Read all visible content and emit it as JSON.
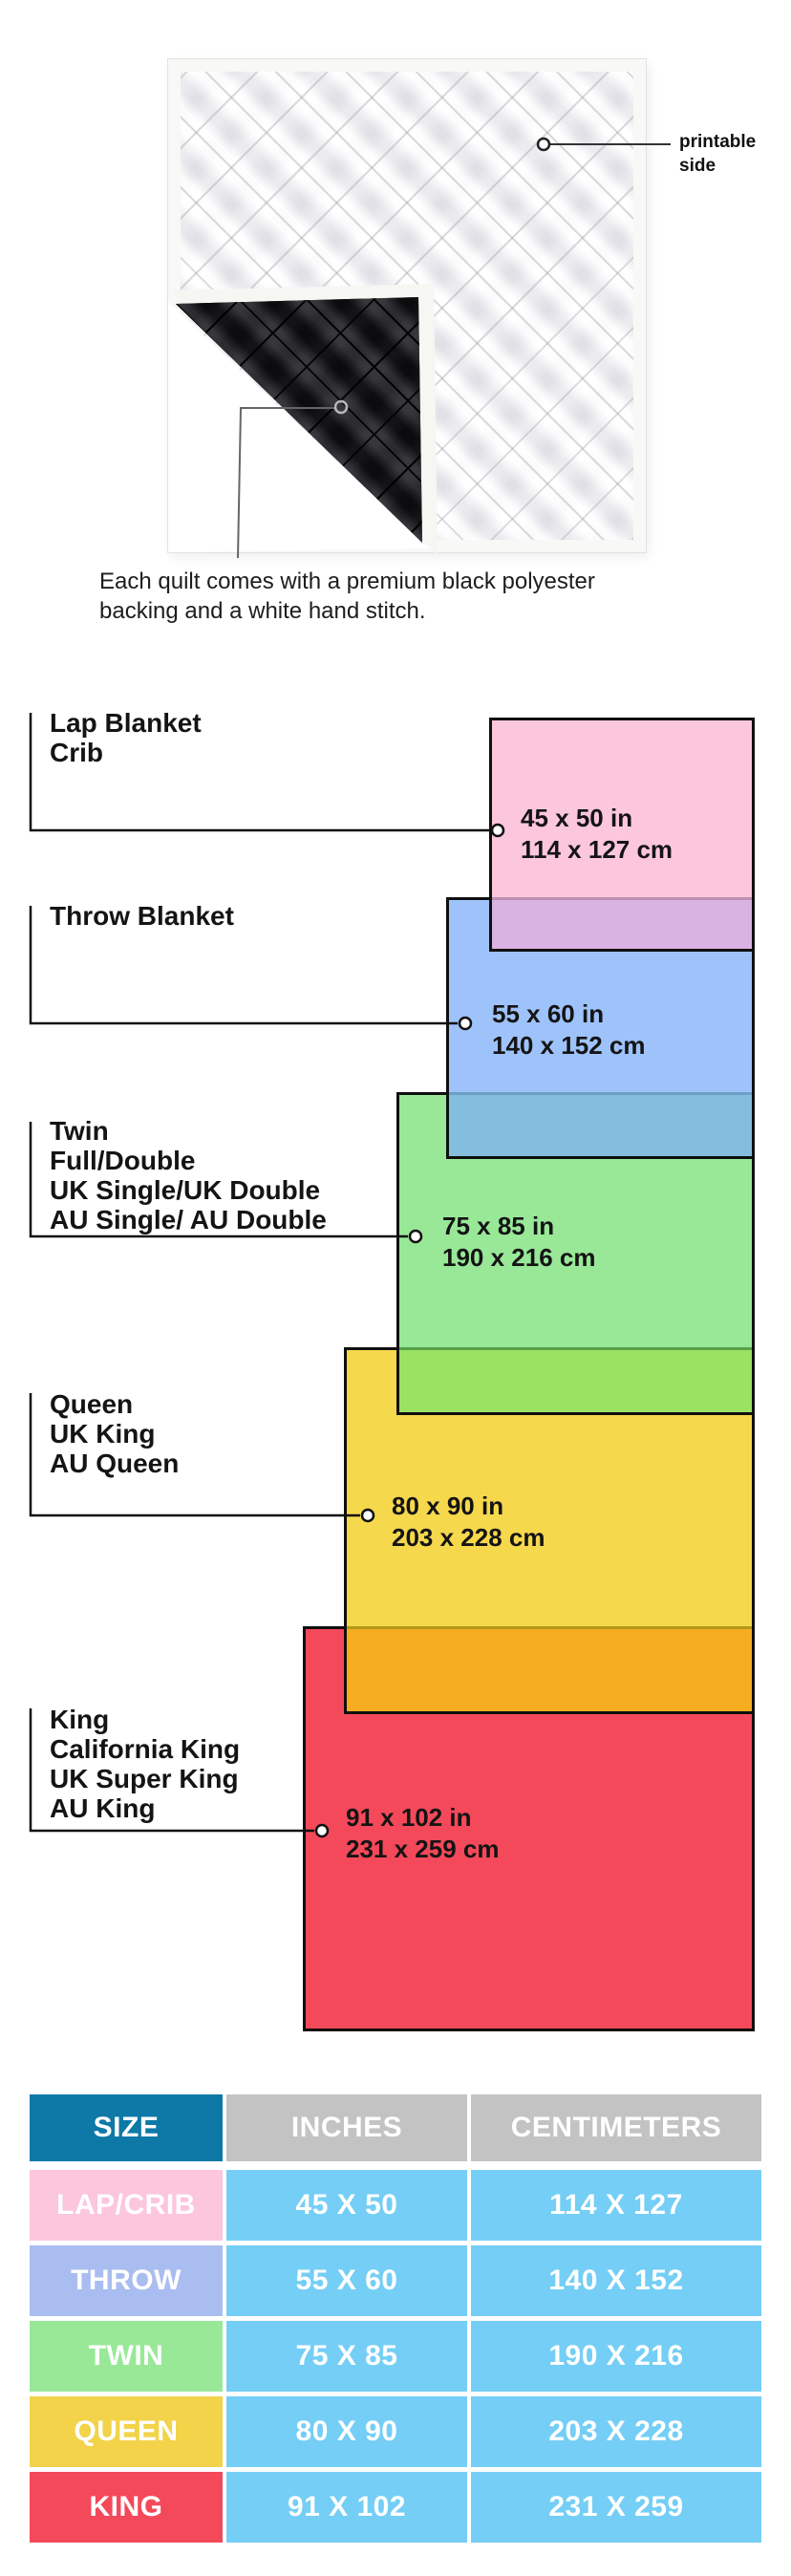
{
  "photo": {
    "printable_side_label_line1": "printable",
    "printable_side_label_line2": "side",
    "caption_line1": "Each quilt comes with a premium black polyester",
    "caption_line2": "backing and a white hand stitch."
  },
  "diagram": {
    "items": [
      {
        "names": [
          "Lap Blanket",
          "Crib"
        ],
        "inches": "45 x 50 in",
        "cm": "114 x 127 cm"
      },
      {
        "names": [
          "Throw Blanket"
        ],
        "inches": "55 x 60 in",
        "cm": "140 x 152 cm"
      },
      {
        "names": [
          "Twin",
          "Full/Double",
          "UK Single/UK Double",
          "AU Single/ AU Double"
        ],
        "inches": "75 x 85 in",
        "cm": "190 x 216 cm"
      },
      {
        "names": [
          "Queen",
          "UK King",
          "AU Queen"
        ],
        "inches": "80 x 90 in",
        "cm": "203 x 228 cm"
      },
      {
        "names": [
          "King",
          "California King",
          "UK Super King",
          "AU King"
        ],
        "inches": "91 x 102 in",
        "cm": "231 x 259 cm"
      }
    ]
  },
  "colors": {
    "pink": "#fcc6dd",
    "pink_overlap": "#d9b3e1",
    "pink_overlap_line": "#bd8fb4",
    "blue": "#9ec2fa",
    "blue_overlap": "#84bedd",
    "blue_overlap_line": "#6b9fc6",
    "green": "#98e898",
    "green_overlap": "#99e262",
    "green_overlap_line": "#55a148",
    "yellow": "#f6d84c",
    "yellow_overlap": "#f6ae20",
    "yellow_overlap_line": "#b2981b",
    "red": "#f4495a",
    "table_header_blue": "#0e79a7",
    "table_header_gray": "#c3c3c3",
    "table_cell_blue": "#74cef5",
    "row_pink": "#fcc6dd",
    "row_blue": "#aabdf0",
    "row_green": "#98e898",
    "row_yellow": "#f2d349",
    "row_red": "#f4495a"
  },
  "table": {
    "headers": [
      "SIZE",
      "INCHES",
      "CENTIMETERS"
    ],
    "rows": [
      {
        "size": "LAP/CRIB",
        "inches": "45 X 50",
        "cm": "114 X 127"
      },
      {
        "size": "THROW",
        "inches": "55 X 60",
        "cm": "140 X 152"
      },
      {
        "size": "TWIN",
        "inches": "75 X 85",
        "cm": "190 X 216"
      },
      {
        "size": "QUEEN",
        "inches": "80 X 90",
        "cm": "203 X 228"
      },
      {
        "size": "KING",
        "inches": "91 X 102",
        "cm": "231 X 259"
      }
    ]
  }
}
